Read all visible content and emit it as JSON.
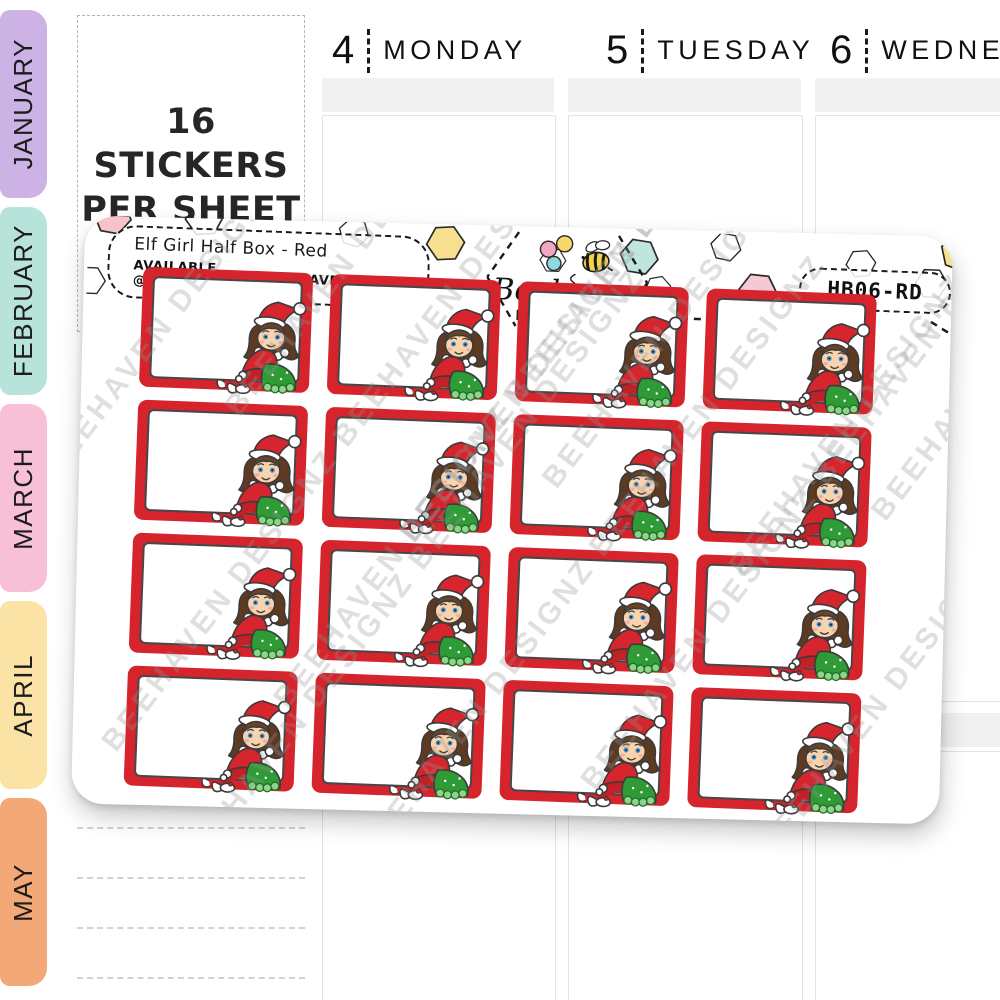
{
  "months": [
    "JANUARY",
    "FEBRUARY",
    "MARCH",
    "APRIL",
    "MAY"
  ],
  "banner": {
    "line1": "16 STICKERS",
    "line2": "PER SHEET"
  },
  "days": [
    {
      "num": "4",
      "name": "MONDAY"
    },
    {
      "num": "5",
      "name": "TUESDAY"
    },
    {
      "num": "6",
      "name": "WEDNESDAY"
    }
  ],
  "sheet": {
    "title": "Elf Girl Half Box - Red",
    "available_prefix": "AVAILABLE @",
    "available_site": "PLANNERSAVENUE.COM",
    "sku": "HB06-RD",
    "sticker_count": 16,
    "grid": {
      "rows": 4,
      "cols": 4
    },
    "watermark": "BEEHAVEN DESIGNZ"
  },
  "logo": {
    "name": "Beehaven",
    "sub": "DESIGNZ"
  },
  "colors": {
    "tab_colors": [
      "#cdb2e6",
      "#b7e3db",
      "#f8c0d6",
      "#fbe3a6",
      "#f3a878"
    ],
    "sticker_red": "#d5242b",
    "skirt_green": "#2f9b36",
    "hat_red": "#d6252c",
    "watermark_gray": "#969696"
  }
}
